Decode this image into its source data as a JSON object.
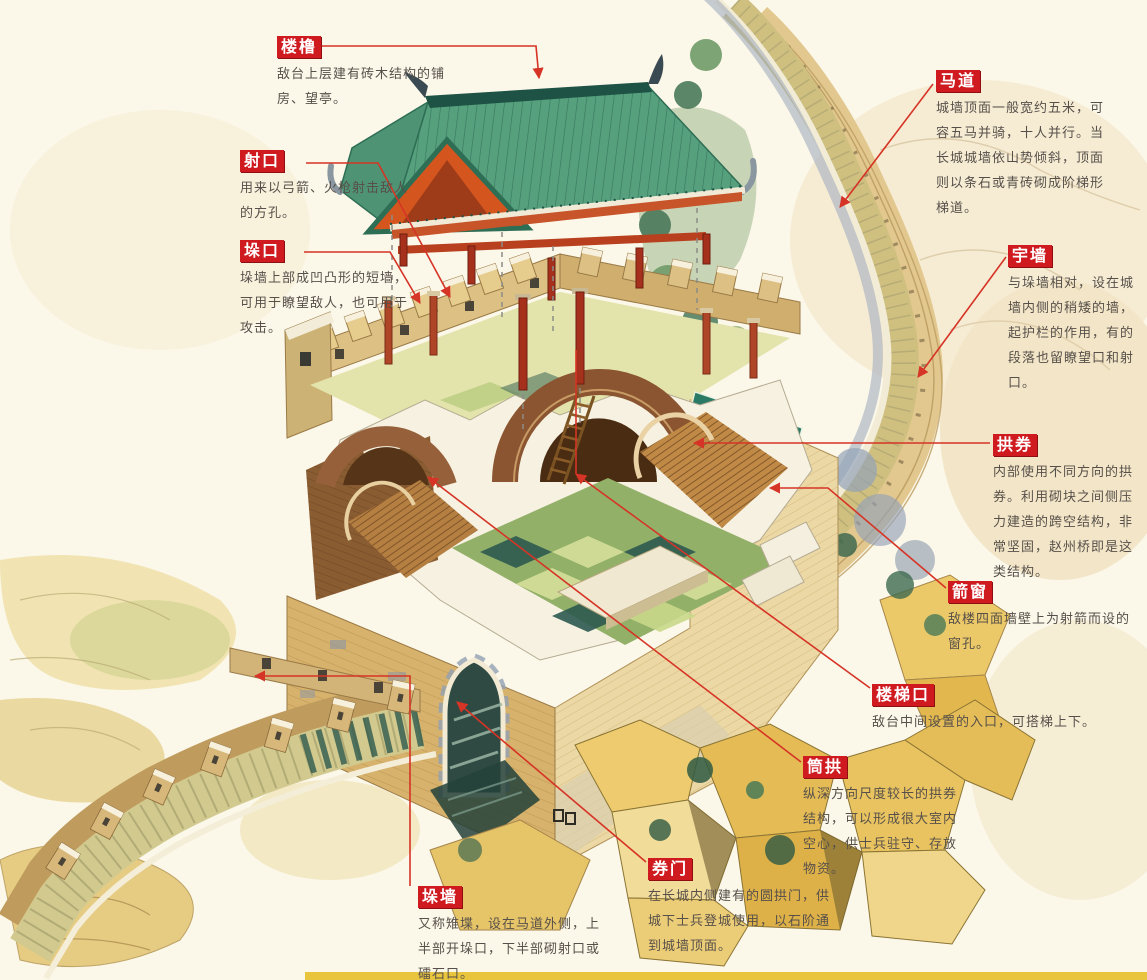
{
  "diagram": {
    "subject": "Great Wall watchtower cutaway illustration",
    "colors": {
      "background": "#fbf7e9",
      "label_tag_red": "#cf1a1f",
      "label_text_white": "#ffffff",
      "description_text": "#57504a",
      "leader_line_red": "#d63426",
      "roof_green": "#57a07e",
      "roof_ridge_teal": "#1d5244",
      "beam_red_orange": "#c8542a",
      "brick_tan": "#d7b26c",
      "brick_light": "#ecd8a4",
      "arch_brown": "#8a5530",
      "floor_green": "#93b069",
      "rock_gold": "#eecb6e",
      "bottom_bar_yellow": "#e9c53e"
    }
  },
  "labels": [
    {
      "id": "loulu",
      "tag": "楼橹",
      "desc": "敌台上层建有砖木结构的铺房、望亭。"
    },
    {
      "id": "shekou",
      "tag": "射口",
      "desc": "用来以弓箭、火枪射击敌人的方孔。"
    },
    {
      "id": "duokou",
      "tag": "垛口",
      "desc": "垛墙上部成凹凸形的短墙，可用于瞭望敌人，也可用于攻击。"
    },
    {
      "id": "madao",
      "tag": "马道",
      "desc": "城墙顶面一般宽约五米，可容五马并骑，十人并行。当长城城墙依山势倾斜，顶面则以条石或青砖砌成阶梯形梯道。"
    },
    {
      "id": "yuqiang",
      "tag": "宇墙",
      "desc": "与垛墙相对，设在城墙内侧的稍矮的墙，起护栏的作用，有的段落也留瞭望口和射口。"
    },
    {
      "id": "gongquan",
      "tag": "拱券",
      "desc": "内部使用不同方向的拱券。利用砌块之间侧压力建造的跨空结构，非常坚固，赵州桥即是这类结构。"
    },
    {
      "id": "jianchuang",
      "tag": "箭窗",
      "desc": "敌楼四面墙壁上为射箭而设的窗孔。"
    },
    {
      "id": "loutikou",
      "tag": "楼梯口",
      "desc": "敌台中间设置的入口，可搭梯上下。"
    },
    {
      "id": "tonggong",
      "tag": "筒拱",
      "desc": "纵深方向尺度较长的拱券结构，可以形成很大室内空心，供士兵驻守、存放物资。"
    },
    {
      "id": "quanmen",
      "tag": "券门",
      "desc": "在长城内侧建有的圆拱门，供城下士兵登城使用，以石阶通到城墙顶面。"
    },
    {
      "id": "duoqiang",
      "tag": "垛墙",
      "desc": "又称雉堞，设在马道外侧，上半部开垛口，下半部砌射口或礌石口。"
    }
  ]
}
